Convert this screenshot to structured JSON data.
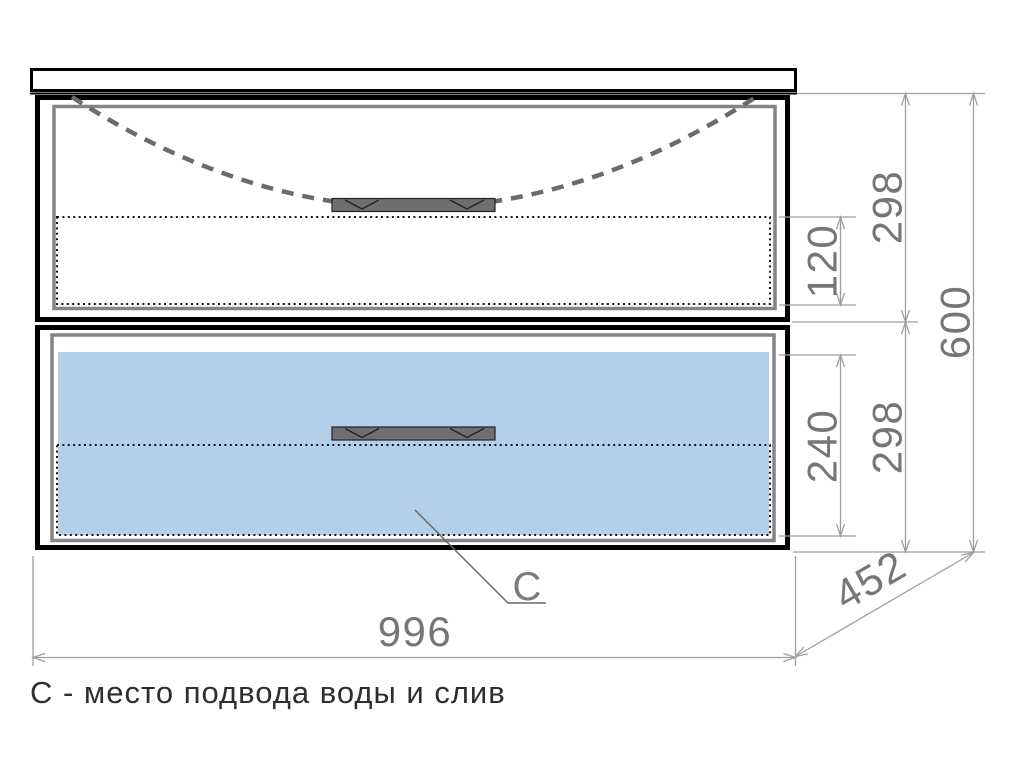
{
  "drawing": {
    "legend": "С - место подвода воды и слив",
    "c_marker": "C"
  },
  "dimensions": {
    "top_facade_height": "298",
    "top_inner_height": "120",
    "bottom_inner_height": "240",
    "bottom_facade_height": "298",
    "total_height": "600",
    "depth": "452",
    "width": "996"
  },
  "colors": {
    "water-zone-fill": "#b3cfea",
    "cabinet-outline": "#000000",
    "front-outline": "#848484",
    "dash-curve": "#6b6b6b",
    "handle-fill": "#6f6f6f",
    "dim-line": "#9f9f9f",
    "dim-text": "#767676",
    "legend-text": "#2e2e2e"
  }
}
